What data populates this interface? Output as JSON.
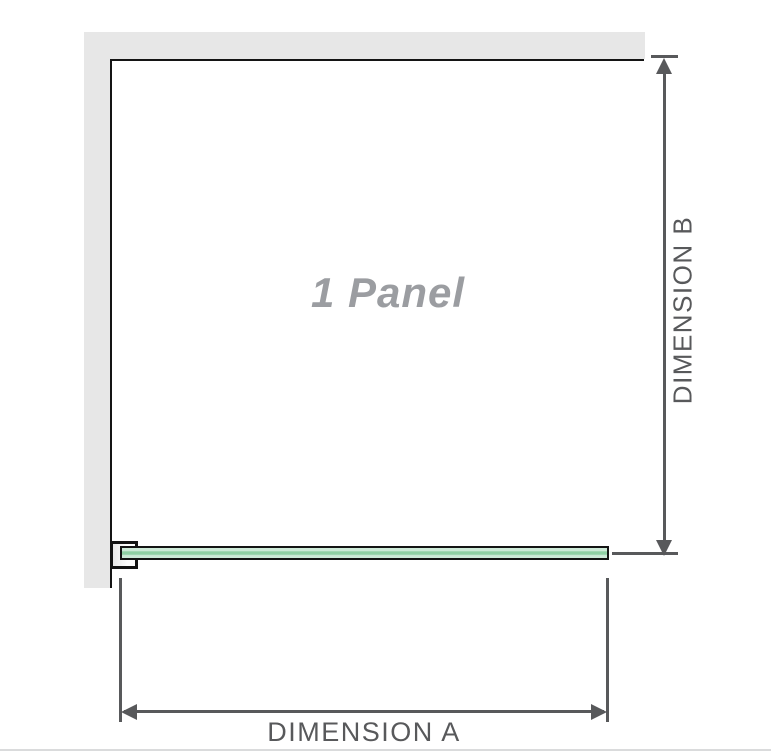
{
  "diagram": {
    "title": "shower-panel-dimension-diagram",
    "panel_label": "1 Panel",
    "dimension_a": {
      "label": "DIMENSION A",
      "orientation": "horizontal"
    },
    "dimension_b": {
      "label": "DIMENSION B",
      "orientation": "vertical"
    }
  },
  "colors": {
    "bg": "#ffffff",
    "wall": "#e7e7e7",
    "line": "#141414",
    "dim": "#58595b",
    "panel_text": "#9b9da1",
    "glass_light": "#cdead8",
    "glass_core": "#8fd0a4",
    "divider": "#dadbdc"
  }
}
